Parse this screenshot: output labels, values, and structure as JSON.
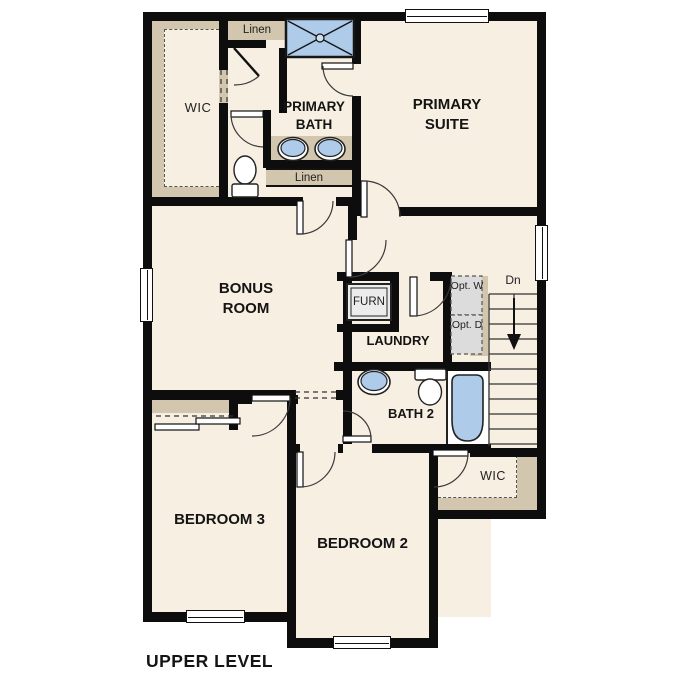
{
  "plan": {
    "footer_label": "UPPER LEVEL",
    "rooms": {
      "wic_primary": {
        "label": "WIC"
      },
      "linen_top": {
        "label": "Linen"
      },
      "primary_bath": {
        "label": "PRIMARY BATH"
      },
      "primary_suite": {
        "label": "PRIMARY SUITE"
      },
      "linen_bath": {
        "label": "Linen"
      },
      "bonus_room": {
        "label": "BONUS ROOM"
      },
      "furnace": {
        "label": "FURN"
      },
      "laundry": {
        "label": "LAUNDRY"
      },
      "opt_washer": {
        "label": "Opt. W"
      },
      "opt_dryer": {
        "label": "Opt. D"
      },
      "stairs": {
        "label": "Dn"
      },
      "bath2": {
        "label": "BATH 2"
      },
      "wic2": {
        "label": "WIC"
      },
      "bedroom3": {
        "label": "BEDROOM 3"
      },
      "bedroom2": {
        "label": "BEDROOM 2"
      }
    },
    "colors": {
      "wall": "#0d0d0d",
      "floor": "#f7efe2",
      "closet_fill": "#d2c6ae",
      "fixture_blue": "#aecbea",
      "appliance_gray": "#dcdcdc",
      "door_arc": "#3a3a3a",
      "background": "#ffffff"
    }
  }
}
